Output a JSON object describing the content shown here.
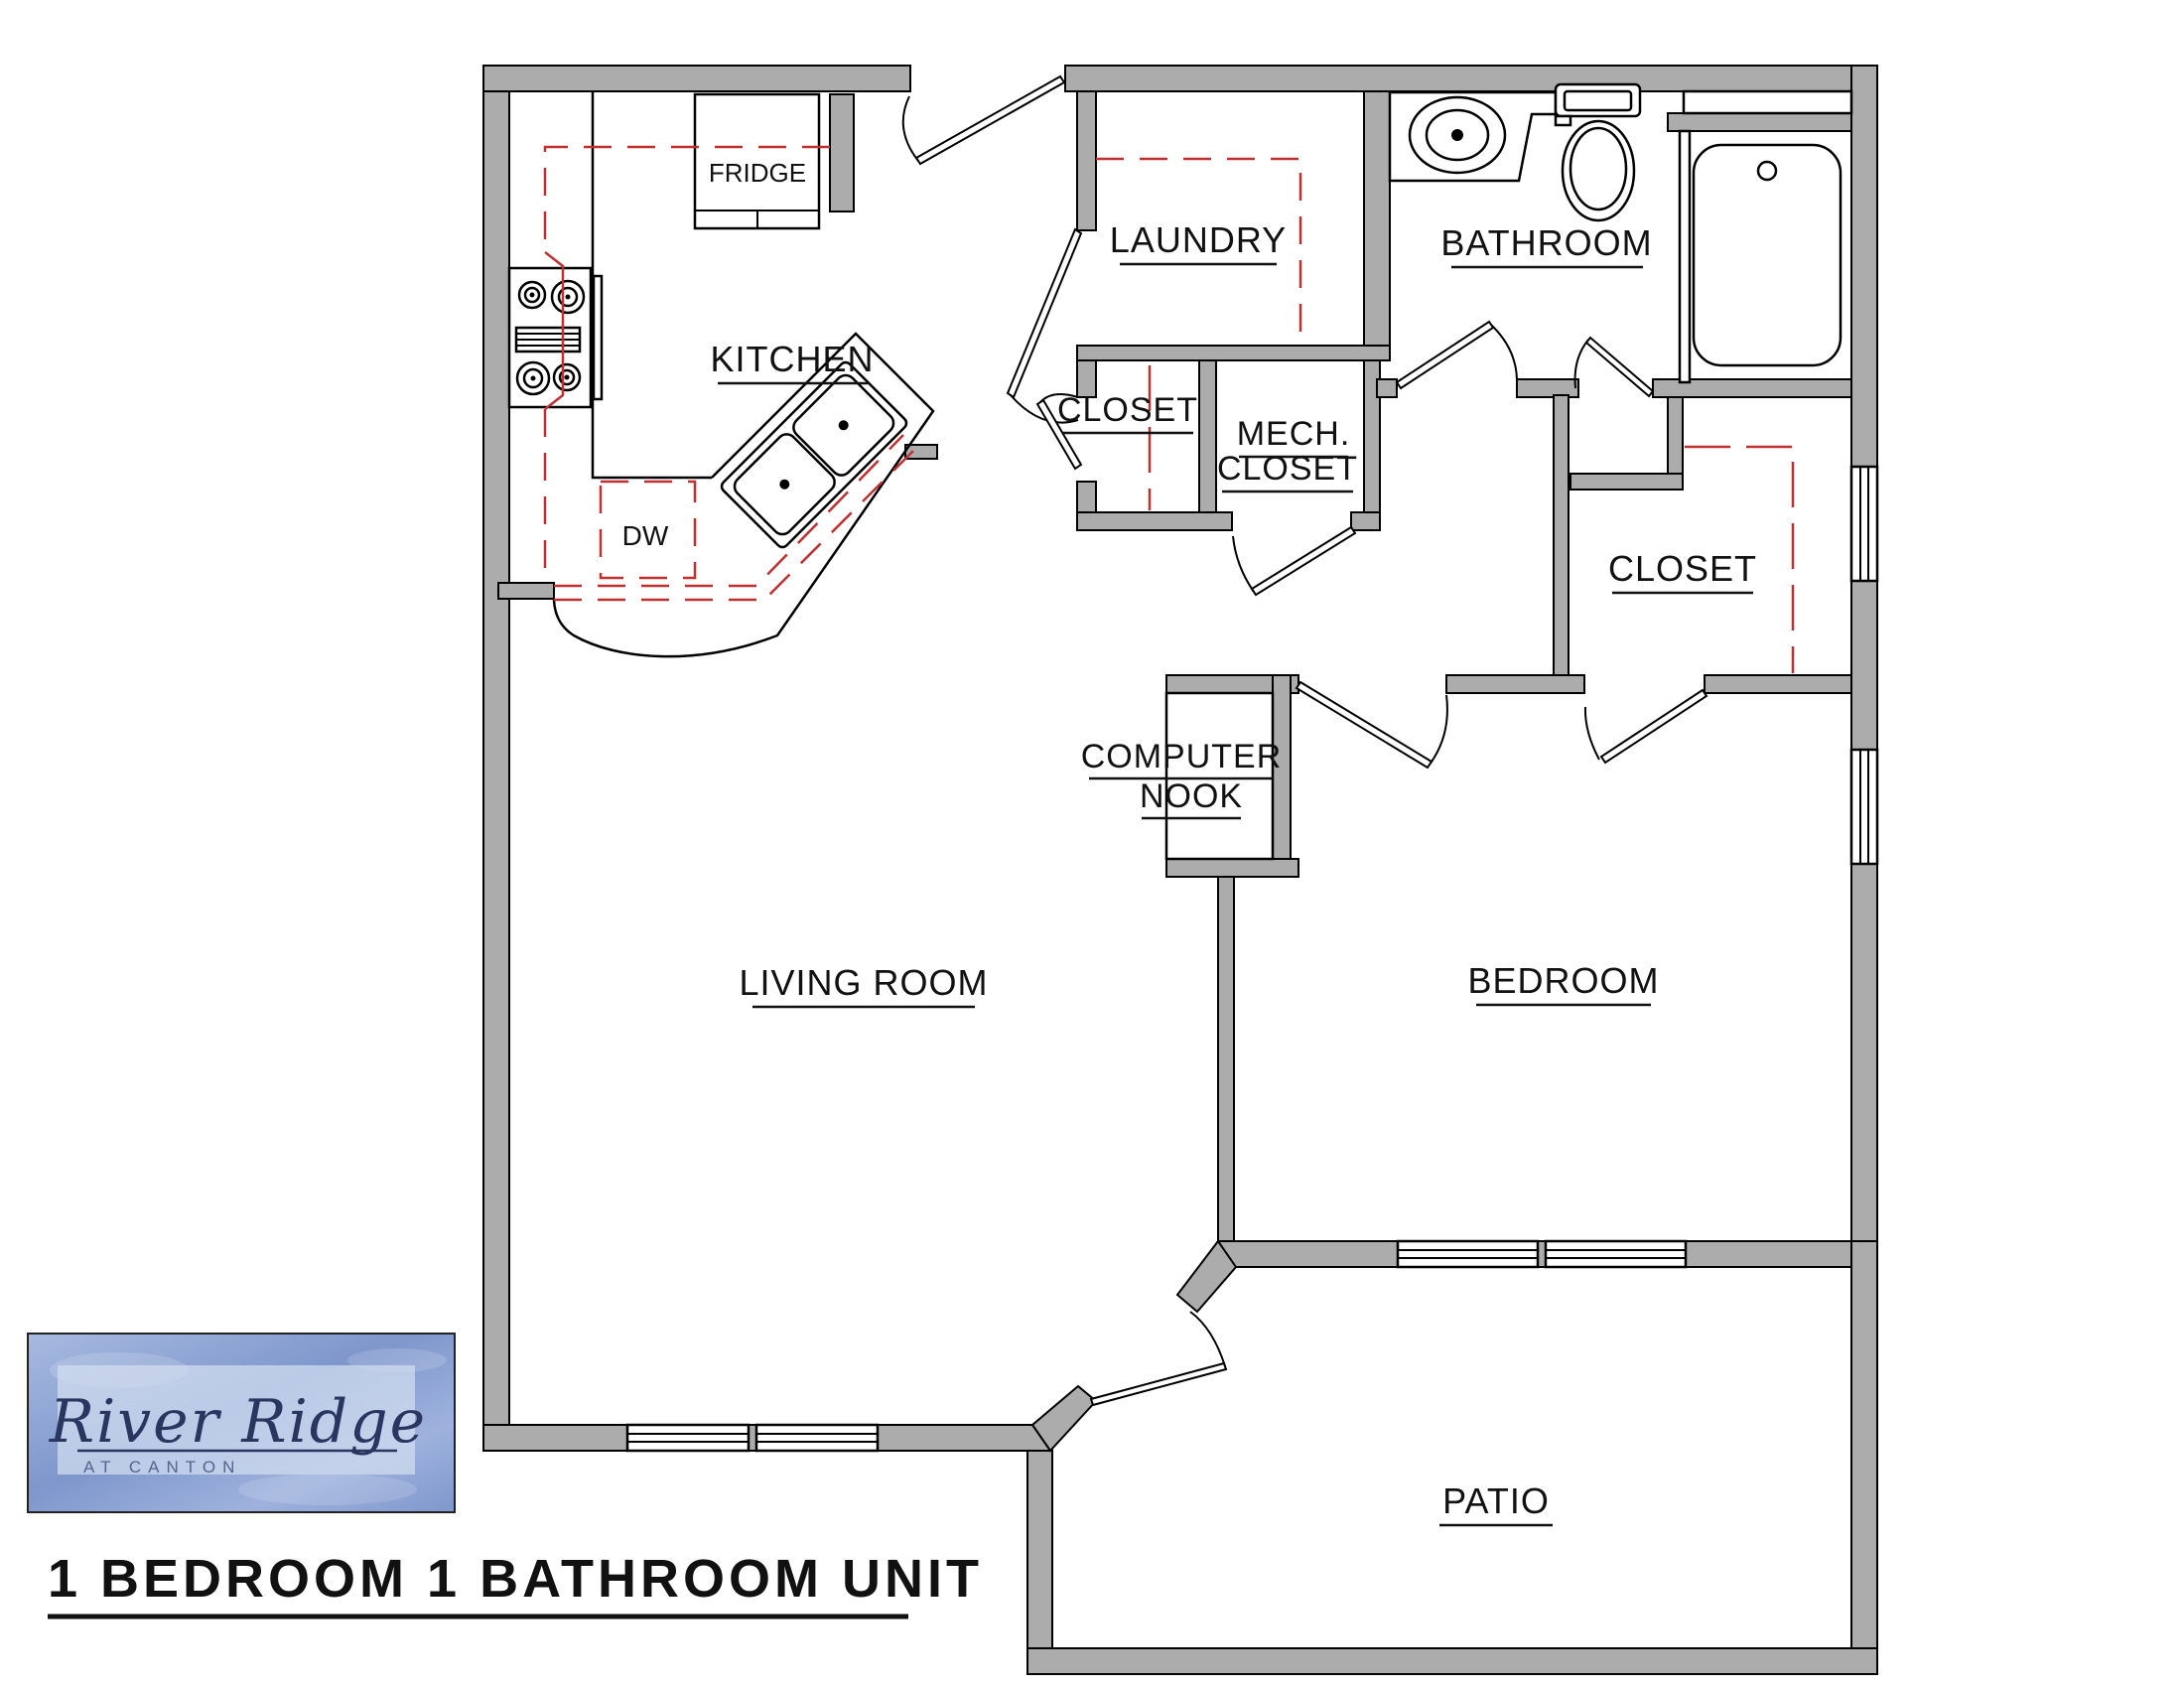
{
  "title": {
    "text": "1 BEDROOM 1 BATHROOM UNIT"
  },
  "logo": {
    "name": "River Ridge",
    "tagline": "AT CANTON"
  },
  "rooms": {
    "kitchen": {
      "label": "KITCHEN"
    },
    "laundry": {
      "label": "LAUNDRY"
    },
    "bathroom": {
      "label": "BATHROOM"
    },
    "laundry_closet": {
      "label": "CLOSET"
    },
    "mech_closet": {
      "label_line1": "MECH.",
      "label_line2": "CLOSET"
    },
    "bedroom_closet": {
      "label": "CLOSET"
    },
    "computer_nook": {
      "label_line1": "COMPUTER",
      "label_line2": "NOOK"
    },
    "living_room": {
      "label": "LIVING ROOM"
    },
    "bedroom": {
      "label": "BEDROOM"
    },
    "patio": {
      "label": "PATIO"
    }
  },
  "appliances": {
    "fridge": {
      "label": "FRIDGE"
    },
    "dishwasher": {
      "label": "DW"
    }
  },
  "fixtures": [
    "stove-icon",
    "kitchen-island-sink-icon",
    "bathroom-sink-icon",
    "toilet-icon",
    "bathtub-icon",
    "door-swing-icon",
    "window-icon"
  ],
  "colors": {
    "wall_fill": "#ACACAC",
    "wall_stroke": "#000000",
    "counter_dash": "#BF3030",
    "logo_bg": "#93A9D6",
    "logo_panel": "#D3DEF0",
    "logo_text": "#2A3560",
    "label_text": "#111111"
  }
}
